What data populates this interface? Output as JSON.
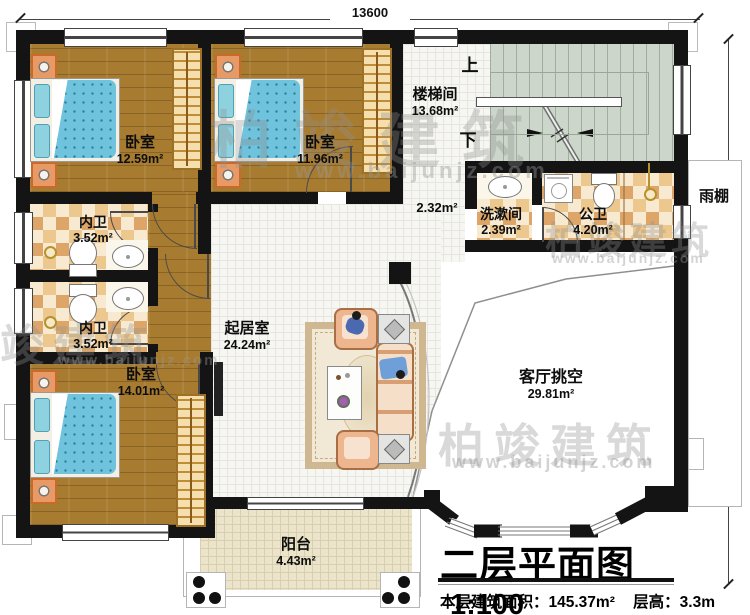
{
  "plan": {
    "dim_top": "13600",
    "dim_right": "11400",
    "title": "二层平面图",
    "scale": "1:100",
    "floor_area": "本层建筑面积：145.37m²",
    "floor_height": "层高：3.3m",
    "watermark_brand": "柏竣建筑",
    "watermark_url": "www.baijunjz.com"
  },
  "rooms": {
    "bedroom_top_left": {
      "name": "卧室",
      "area": "12.59m²"
    },
    "bedroom_top_mid": {
      "name": "卧室",
      "area": "11.96m²"
    },
    "bedroom_bottom_left": {
      "name": "卧室",
      "area": "14.01m²"
    },
    "stairwell": {
      "name": "楼梯间",
      "area": "13.68m²",
      "up": "上",
      "down": "下"
    },
    "corridor": {
      "area": "2.32m²"
    },
    "washroom": {
      "name": "洗漱间",
      "area": "2.39m²"
    },
    "public_bathroom": {
      "name": "公卫",
      "area": "4.20m²"
    },
    "ensuite_bathroom_1": {
      "name": "内卫",
      "area": "3.52m²"
    },
    "ensuite_bathroom_2": {
      "name": "内卫",
      "area": "3.52m²"
    },
    "family_room": {
      "name": "起居室",
      "area": "24.24m²"
    },
    "living_room_void": {
      "name": "客厅挑空",
      "area": "29.81m²"
    },
    "balcony": {
      "name": "阳台",
      "area": "4.43m²"
    },
    "rain_canopy": {
      "name": "雨棚"
    }
  },
  "colors": {
    "wall": "#141414",
    "wood_floor": "#a87c30",
    "bath_tile": "#ecc78e",
    "stair_floor": "#ccd6ca",
    "mattress_blue": "#6fc3dc",
    "sofa_peach": "#edb68f",
    "balcony_tile": "#ebe4ca"
  }
}
